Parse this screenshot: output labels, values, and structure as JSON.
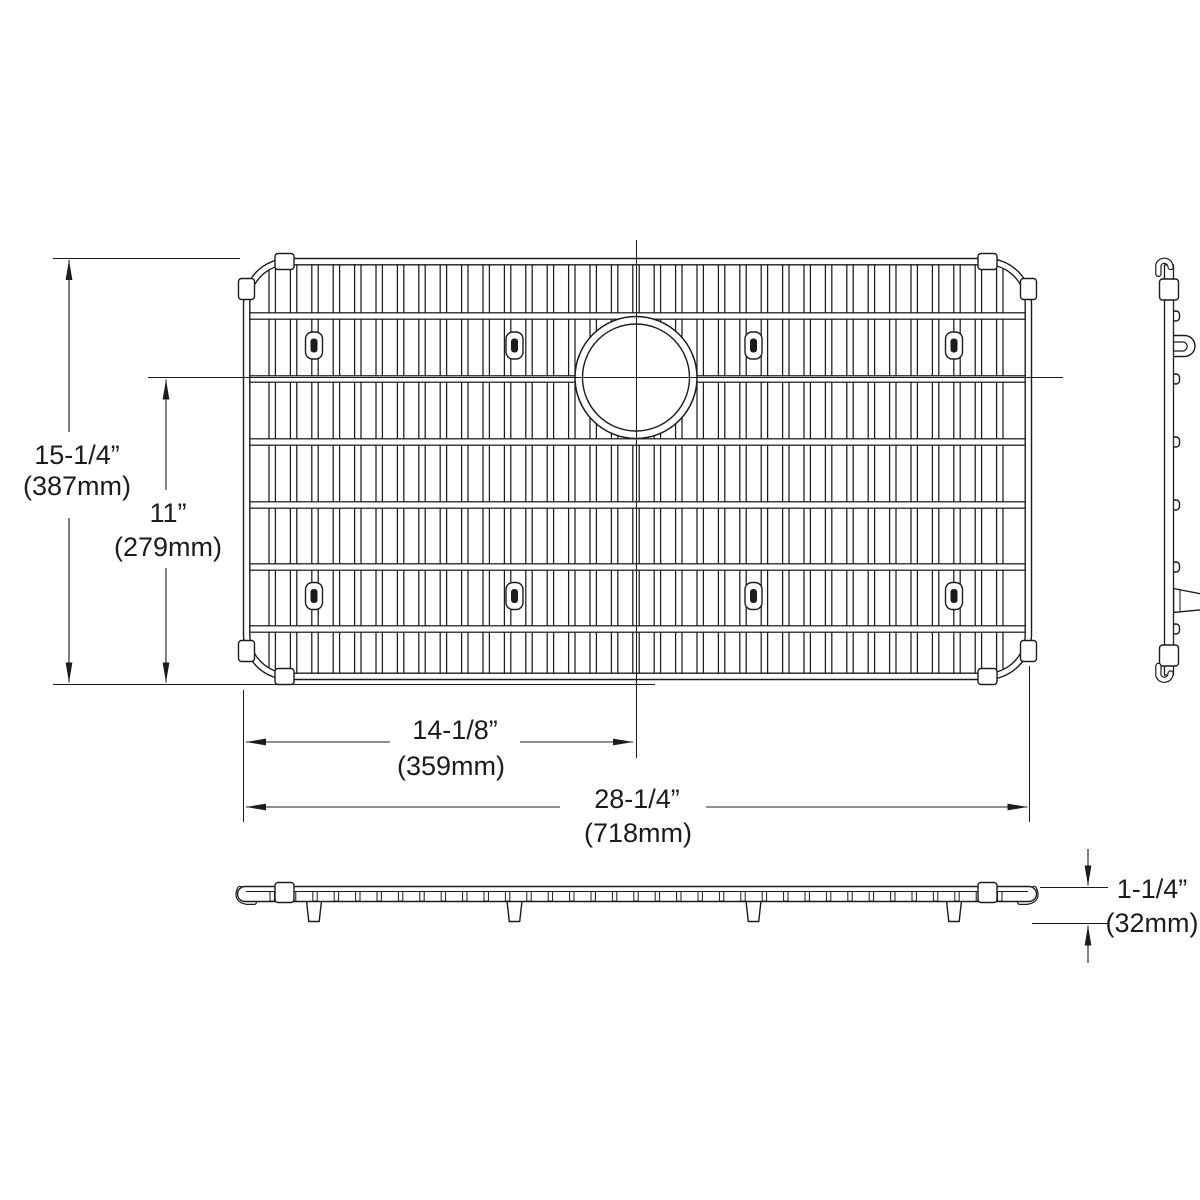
{
  "drawing_type": "sink-bottom-grid technical drawing",
  "dimensions": {
    "overall_height": {
      "value": "15-1/4”",
      "metric": "(387mm)"
    },
    "drain_center_to_bottom": {
      "value": "11”",
      "metric": "(279mm)"
    },
    "left_to_drain_center": {
      "value": "14-1/8”",
      "metric": "(359mm)"
    },
    "overall_width": {
      "value": "28-1/4”",
      "metric": "(718mm)"
    },
    "profile_height": {
      "value": "1-1/4”",
      "metric": "(32mm)"
    }
  },
  "geometry": {
    "line_color": "#1c1c1c",
    "top_view": {
      "x": 243.5,
      "y": 258.5,
      "width": 788,
      "height": 421,
      "corner_radius": 45,
      "wire_first_x": 272.2,
      "wire_step": 21.4,
      "wire_count": 35,
      "wire_top_y": 263,
      "wire_bottom_y": 675,
      "crossbar_ys": [
        316,
        379,
        442,
        505,
        567,
        629
      ],
      "crossbar_x1": 248.5,
      "crossbar_x2": 1026.5,
      "clip_xs": [
        314,
        514.5,
        753.5,
        954
      ],
      "clip_row_ys": [
        345.5,
        596
      ],
      "rim_collar_xs": [
        284.5,
        987.5
      ],
      "rim_ys": [
        261.5,
        676.5
      ],
      "rim_collar_ys": [
        289,
        651
      ],
      "rim_xs": [
        246.5,
        1028.5
      ]
    },
    "drain": {
      "cx": 636,
      "cy": 377.5,
      "outer_r": 61,
      "inner_r": 53.5
    },
    "side_view": {
      "bump_x": 1172,
      "bump_w": 7.5,
      "bump_h": 10
    },
    "front_view": {
      "tick_top_y": 891.5,
      "tick_h": 9.5,
      "foot_top_y": 901,
      "foot_bottom_y": 921.5,
      "foot_half_top": 7.5,
      "foot_half_bottom": 5.2
    }
  }
}
